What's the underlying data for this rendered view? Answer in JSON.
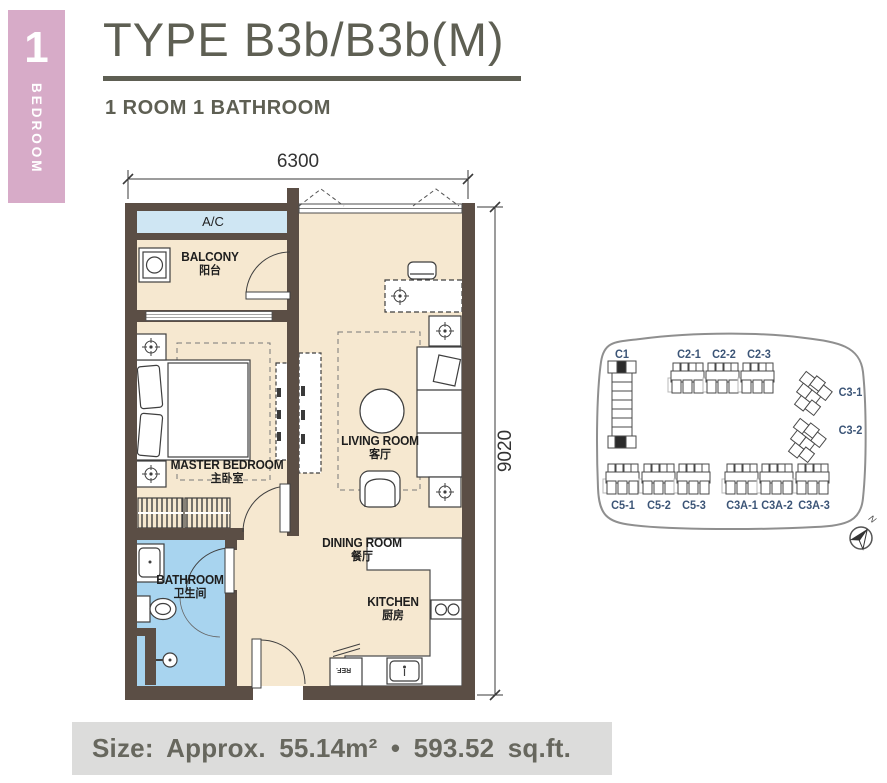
{
  "tab": {
    "number": "1",
    "label": "BEDROOM"
  },
  "header": {
    "title": "TYPE B3b/B3b(M)",
    "subtitle": "1 ROOM 1 BATHROOM"
  },
  "dimensions": {
    "width": "6300",
    "height": "9020"
  },
  "rooms": {
    "ac": {
      "en": "A/C"
    },
    "balcony": {
      "en": "BALCONY",
      "cn": "阳台"
    },
    "master_bedroom": {
      "en": "MASTER BEDROOM",
      "cn": "主卧室"
    },
    "living_room": {
      "en": "LIVING ROOM",
      "cn": "客厅"
    },
    "dining_room": {
      "en": "DINING ROOM",
      "cn": "餐厅"
    },
    "kitchen": {
      "en": "KITCHEN",
      "cn": "厨房"
    },
    "bathroom": {
      "en": "BATHROOM",
      "cn": "卫生间"
    },
    "ref": "REF."
  },
  "keyplan": {
    "blocks": [
      "C1",
      "C2-1",
      "C2-2",
      "C2-3",
      "C3-1",
      "C3-2",
      "C5-1",
      "C5-2",
      "C5-3",
      "C3A-1",
      "C3A-2",
      "C3A-3"
    ],
    "north_label": "N"
  },
  "footer": {
    "size_text": "Size: Approx. 55.14m² • 593.52 sq.ft."
  },
  "colors": {
    "accent_pink": "#d7abc8",
    "wall_brown": "#5b4e45",
    "floor_beige": "#f6e8d0",
    "bathroom_blue": "#a8d4ef",
    "ac_blue": "#cfe6f3",
    "title_gray": "#5e5f53",
    "footer_bg": "#dcdcdb",
    "keyplan_label_blue": "#3c5577"
  }
}
